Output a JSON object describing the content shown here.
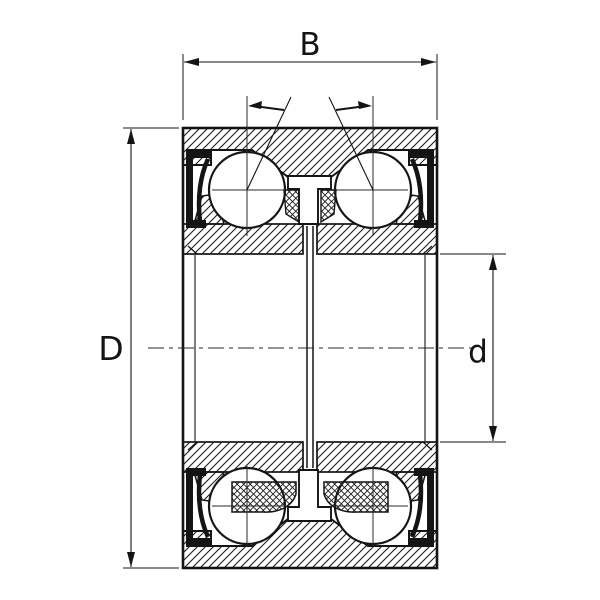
{
  "drawing": {
    "labels": {
      "width_label": "B",
      "outer_diameter_label": "D",
      "bore_diameter_label": "d"
    },
    "colors": {
      "line": "#141414",
      "background": "#ffffff"
    }
  }
}
